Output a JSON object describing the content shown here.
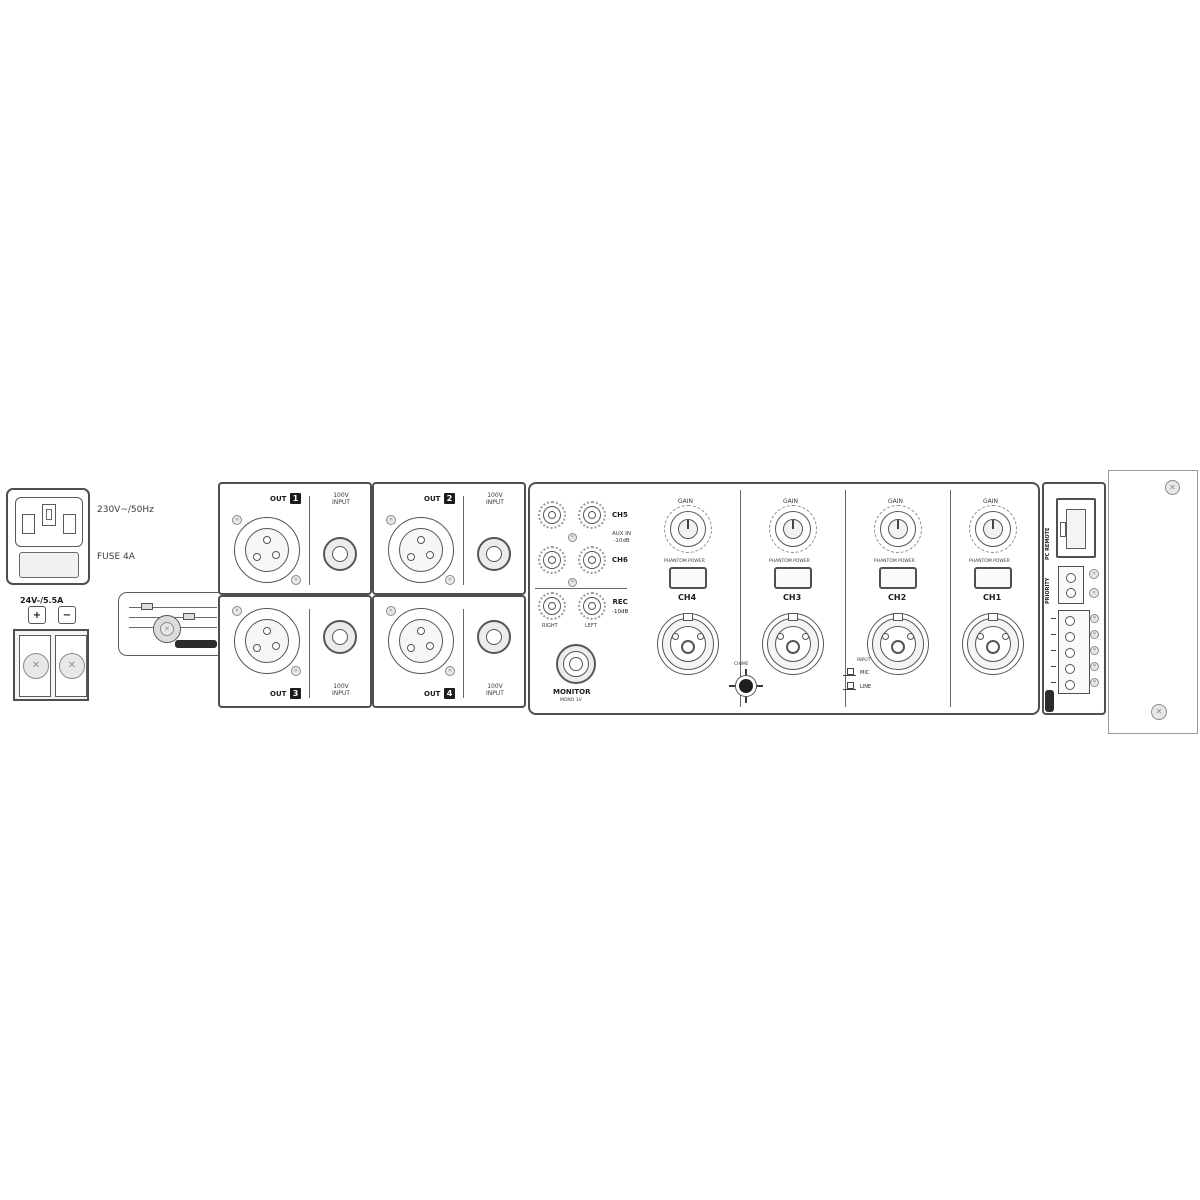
{
  "power": {
    "mains_voltage": "230V~/50Hz",
    "fuse": "FUSE 4A",
    "dc_input": "24V-/5.5A",
    "plus": "+",
    "minus": "−"
  },
  "outputs": {
    "out_label": "OUT",
    "speaker_line1": "100V",
    "speaker_line2": "INPUT",
    "zones": [
      "1",
      "2",
      "3",
      "4"
    ]
  },
  "aux": {
    "ch5": "CH5",
    "aux_in_line1": "AUX IN",
    "aux_in_line2": "-10dB",
    "ch6": "CH6",
    "rec_line1": "REC",
    "rec_line2": "-10dB",
    "right": "RIGHT",
    "left": "LEFT"
  },
  "monitor": {
    "label": "MONITOR",
    "sub": "MONO 1V"
  },
  "channels": [
    {
      "gain": "GAIN",
      "switch": "PHANTOM POWER",
      "name": "CH4"
    },
    {
      "gain": "GAIN",
      "switch": "PHANTOM POWER",
      "name": "CH3"
    },
    {
      "gain": "GAIN",
      "switch": "PHANTOM POWER",
      "name": "CH2"
    },
    {
      "gain": "GAIN",
      "switch": "PHANTOM POWER",
      "name": "CH1"
    }
  ],
  "chime": {
    "label": "CHIME"
  },
  "legend": {
    "caption": "INPUT",
    "row1": "MIC",
    "row2": "LINE"
  },
  "io": {
    "rj45": "PC REMOTE",
    "priority": "PRIORITY"
  },
  "screw_glyph": "✕"
}
